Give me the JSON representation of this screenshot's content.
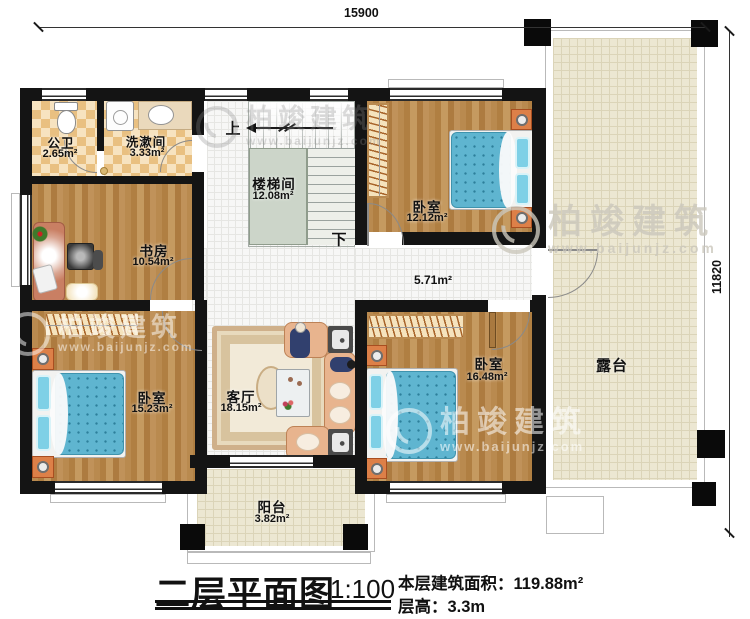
{
  "dimensions": {
    "top": "15900",
    "right": "11820"
  },
  "stairs": {
    "up": "上",
    "down": "下"
  },
  "rooms": [
    {
      "name": "公卫",
      "area": "2.65m²"
    },
    {
      "name": "洗漱间",
      "area": "3.33m²"
    },
    {
      "name": "书房",
      "area": "10.54m²"
    },
    {
      "name": "楼梯间",
      "area": "12.08m²"
    },
    {
      "name": "卧室",
      "area": "12.12m²"
    },
    {
      "name": "",
      "area": "5.71m²"
    },
    {
      "name": "客厅",
      "area": "18.15m²"
    },
    {
      "name": "卧室",
      "area": "15.23m²"
    },
    {
      "name": "卧室",
      "area": "16.48m²"
    },
    {
      "name": "露台",
      "area": ""
    },
    {
      "name": "阳台",
      "area": "3.82m²"
    }
  ],
  "watermark": {
    "brand": "柏竣建筑",
    "url": "www.baijunjz.com"
  },
  "title_block": {
    "title": "二层平面图",
    "scale": "1:100",
    "area_label": "本层建筑面积：",
    "area_value": "119.88m²",
    "floor_height_label": "层高：",
    "floor_height_value": "3.3m"
  },
  "colors": {
    "wall": "#141414",
    "wood_floor": "#b8874e",
    "bathroom_tile": "#e9c081",
    "terrace_floor": "#ece7d2",
    "corridor_tile": "#f7f7f6",
    "bed": "#5fb5d0",
    "sofa": "#e8b48e",
    "stair_landing": "#ccd5c9"
  }
}
